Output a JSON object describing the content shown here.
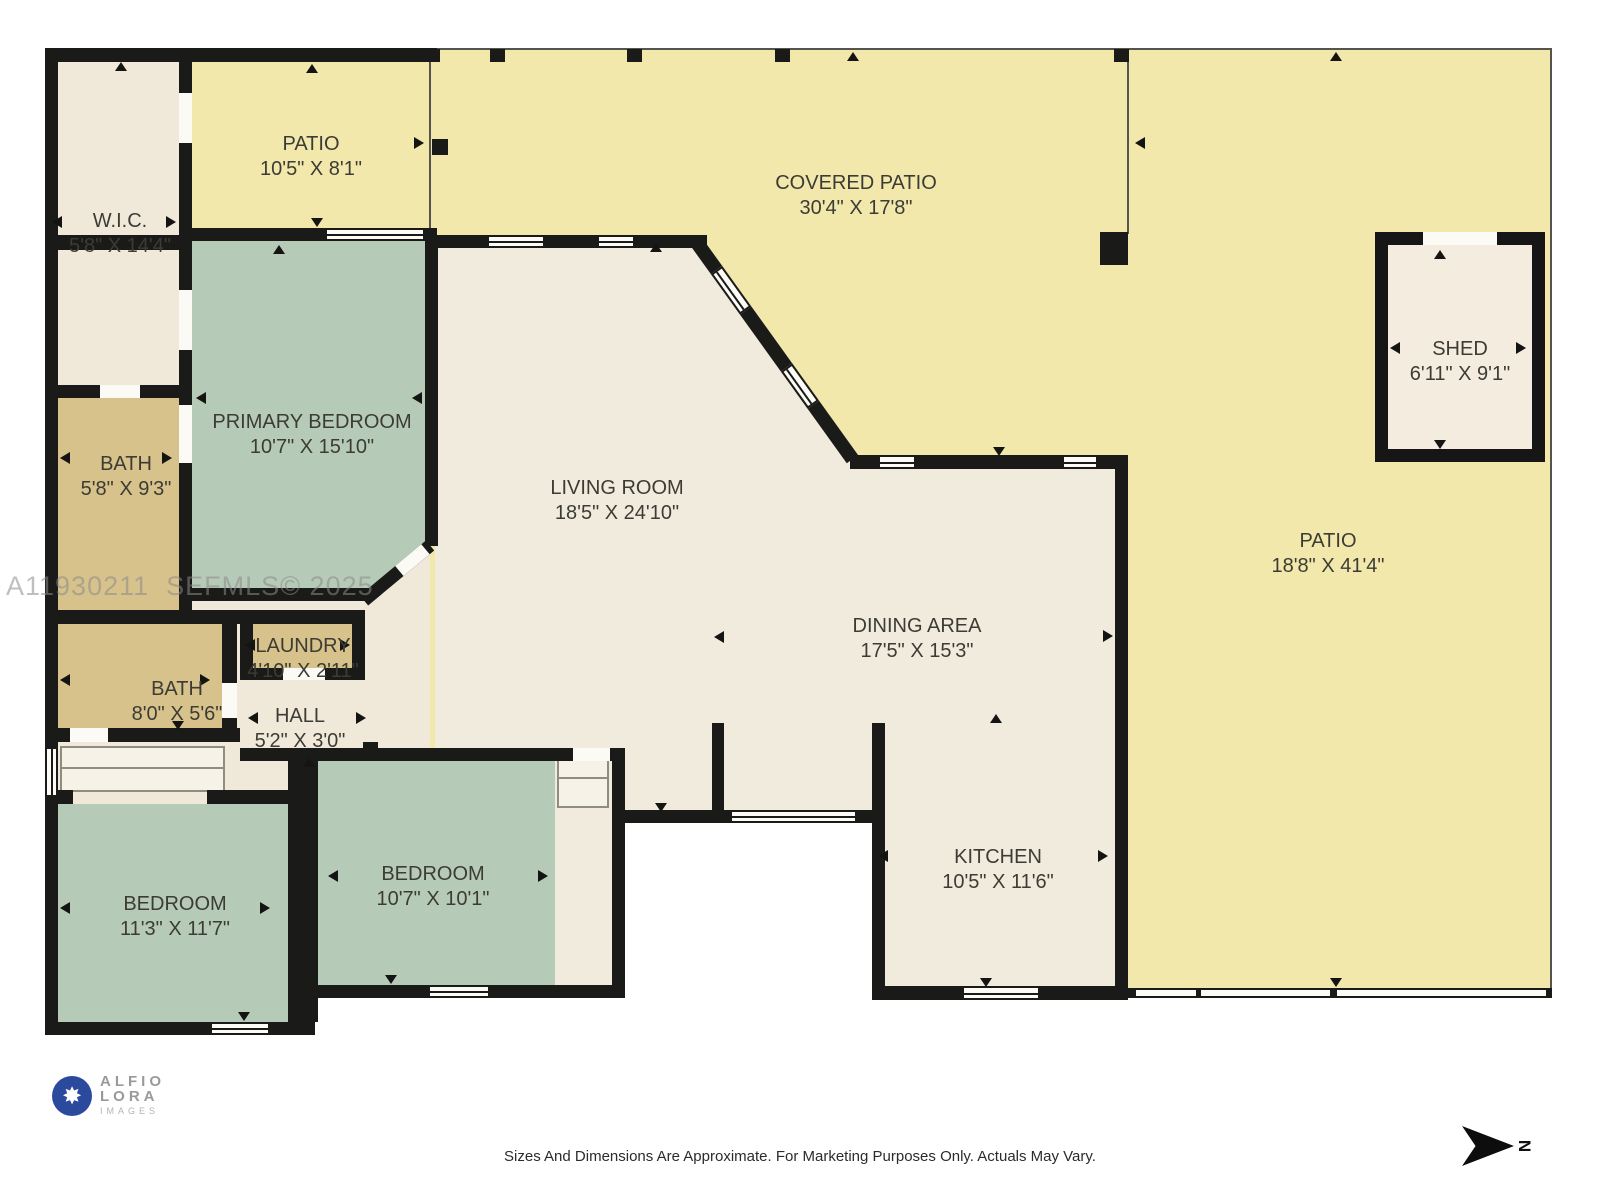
{
  "plan": {
    "rooms": {
      "wic": {
        "name": "W.I.C.",
        "dims": "5'8\" X 14'4\""
      },
      "patio_top": {
        "name": "PATIO",
        "dims": "10'5\" X 8'1\""
      },
      "covered_patio": {
        "name": "COVERED PATIO",
        "dims": "30'4\" X 17'8\""
      },
      "primary_bedroom": {
        "name": "PRIMARY BEDROOM",
        "dims": "10'7\" X 15'10\""
      },
      "bath_top": {
        "name": "BATH",
        "dims": "5'8\" X 9'3\""
      },
      "living_room": {
        "name": "LIVING ROOM",
        "dims": "18'5\" X 24'10\""
      },
      "dining_area": {
        "name": "DINING AREA",
        "dims": "17'5\" X 15'3\""
      },
      "kitchen": {
        "name": "KITCHEN",
        "dims": "10'5\" X 11'6\""
      },
      "laundry": {
        "name": "LAUNDRY",
        "dims": "4'10\" X 2'11\""
      },
      "bath_bottom": {
        "name": "BATH",
        "dims": "8'0\" X 5'6\""
      },
      "hall": {
        "name": "HALL",
        "dims": "5'2\" X 3'0\""
      },
      "bedroom_left": {
        "name": "BEDROOM",
        "dims": "11'3\" X 11'7\""
      },
      "bedroom_mid": {
        "name": "BEDROOM",
        "dims": "10'7\" X 10'1\""
      },
      "shed": {
        "name": "SHED",
        "dims": "6'11\" X 9'1\""
      },
      "patio_right": {
        "name": "PATIO",
        "dims": "18'8\" X 41'4\""
      }
    },
    "watermark": "A11930211  SEFMLS© 2025",
    "compass_label": "N"
  },
  "branding": {
    "logo_line1": "ALFIO",
    "logo_line2": "LORA",
    "logo_line3": "IMAGES",
    "aperture_glyph": "✸"
  },
  "footer": {
    "disclaimer": "Sizes And Dimensions Are Approximate. For Marketing Purposes Only. Actuals May Vary."
  },
  "colors": {
    "patio_yellow": "#f2e8ac",
    "interior_cream": "#f1ebdd",
    "bedroom_green": "#b6cbb7",
    "bath_tan": "#d7c28c",
    "wall_black": "#1a1a18"
  }
}
